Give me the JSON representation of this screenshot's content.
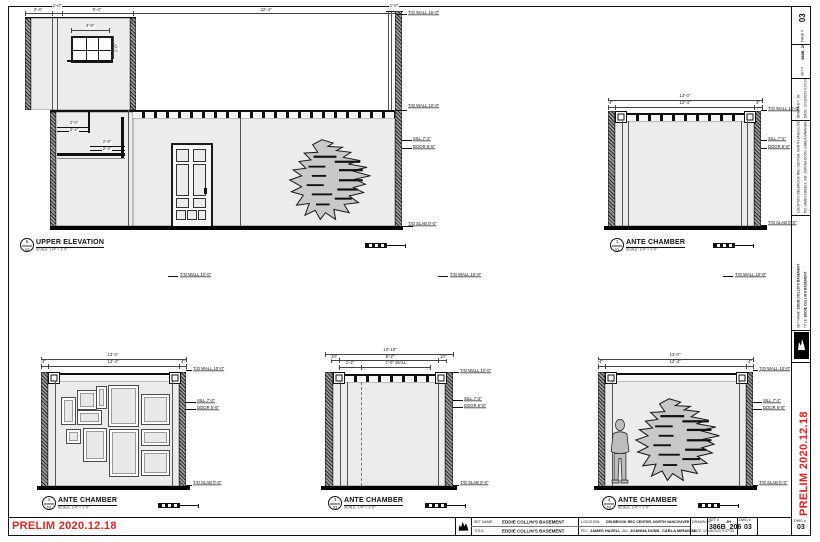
{
  "sheet": {
    "prelim_stamp": "PRELIM 2020.12.18",
    "accent_red": "#e8231f",
    "wall_fill": "#ececec"
  },
  "titleblock": {
    "set_name_label": "SET NAME:",
    "set_name": "EDDIE COLLIN'S BASEMENT",
    "title_label": "TITLE:",
    "title": "EDDIE COLLIN'S BASEMENT",
    "location_label": "LOCATION:",
    "location": "DELBROOK REC CENTER, NORTH VANCOUVER",
    "pd_label": "PD:",
    "pd": "JAMES HAZELL",
    "ad_label": "AD:",
    "ad": "JOANNA DUNN",
    "ad2": "CARLA MIRANDA",
    "drawn_by_label": "DRAWN BY:",
    "drawn_by": "JH",
    "date_label": "DATE:",
    "date": "12/18/2020 9:37:34",
    "set_no_label": "SET #",
    "set_no": "386B_206",
    "dwg_no_label": "DWG #",
    "dwg_no": "03",
    "page_no_label": "PAGE #",
    "page_no": "03"
  },
  "drawings": {
    "upper": {
      "callout_num": "5",
      "callout_sheet": "03",
      "title": "UPPER ELEVATION",
      "scale": "SCALE: 1/4\" = 1'-0\"",
      "dims": {
        "d1": "2'-4\"",
        "d2": "1'-0\"",
        "d3": "5'-4\"",
        "d4": "22'-4\"",
        "window_w": "3'-0\"",
        "window_h": "2'-0\"",
        "wall_cap": "1'-0\"",
        "stair1a": "2'-0\"",
        "stair1b": "2'-4\"",
        "stair2a": "2'-0\"",
        "stair2b": "2'-4\""
      },
      "elevations": [
        "T/O WALL 16'-0\"",
        "T/O WALL 10'-0\"",
        "SILL 7'-2\"",
        "DOOR 6'-8\"",
        "T/O SLAB 0'-0\""
      ]
    },
    "ante1": {
      "callout_num": "1",
      "callout_sheet": "03",
      "title": "ANTE CHAMBER",
      "scale": "SCALE: 1/4\" = 1'-0\"",
      "dims": {
        "overall": "13'-0\"",
        "inner": "12'-4\"",
        "end_left": "4\"",
        "end_right": "4\""
      },
      "elevations": [
        "T/O WALL 10'-0\"",
        "SILL 7'-2\"",
        "DOOR 6'-8\"",
        "T/O SLAB 0'-0\""
      ]
    },
    "ante2": {
      "callout_num": "2",
      "callout_sheet": "03",
      "title": "ANTE CHAMBER",
      "scale": "SCALE: 1/4\" = 1'-0\"",
      "dims": {
        "overall": "13'-0\"",
        "inner": "12'-4\"",
        "end_left": "4\"",
        "end_right": "4\""
      },
      "elevations": [
        "T/O WALL 10'-0\"",
        "SILL 7'-2\"",
        "DOOR 6'-8\"",
        "T/O SLAB 0'-0\""
      ]
    },
    "ante3": {
      "callout_num": "3",
      "callout_sheet": "03",
      "title": "ANTE CHAMBER",
      "scale": "SCALE: 1/4\" = 1'-0\"",
      "dims": {
        "overall": "10'-10\"",
        "seg_left": "10\"",
        "seg_mid": "9'-2\"",
        "seg_right": "10\"",
        "offset": "1'-2\"",
        "wall": "7'-0\" WALL"
      },
      "elevations": [
        "T/O WALL 10'-0\"",
        "SILL 7'-2\"",
        "DOOR 6'-8\"",
        "T/O SLAB 0'-0\""
      ]
    },
    "ante4": {
      "callout_num": "4",
      "callout_sheet": "03",
      "title": "ANTE CHAMBER",
      "scale": "SCALE: 1/4\" = 1'-0\"",
      "dims": {
        "overall": "13'-0\"",
        "inner": "12'-4\"",
        "end_left": "4\"",
        "end_right": "4\""
      },
      "elevations": [
        "T/O WALL 10'-0\"",
        "SILL 7'-2\"",
        "DOOR 6'-8\"",
        "T/O SLAB 0'-0\""
      ]
    }
  },
  "floating_labels": [
    "T/O WALL 10'-0\"",
    "T/O WALL 10'-0\"",
    "T/O WALL 10'-0\""
  ]
}
